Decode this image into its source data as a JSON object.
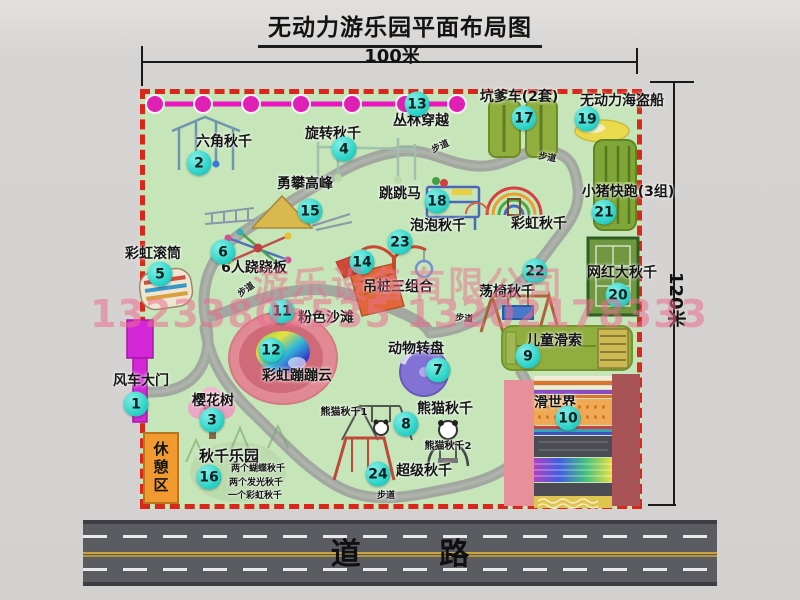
{
  "title": "无动力游乐园平面布局图",
  "dimensions": {
    "width": "100米",
    "height": "120米"
  },
  "road": {
    "label": "道 路"
  },
  "watermark": {
    "company": "游乐设备有限公司",
    "phone": "13233805535 13202178333"
  },
  "rest_area": {
    "label": "休憩区"
  },
  "colors": {
    "map_green": "#c6e6ba",
    "border_red": "#d8281c",
    "chain_magenta": "#e818bc",
    "badge_teal": "#2fd3c8",
    "road_gray": "#5b5b62",
    "rest_orange": "#f09a30"
  },
  "items": [
    {
      "num": "1",
      "label": "风车大门",
      "lx": 141,
      "ly": 374,
      "bx": 136,
      "by": 404
    },
    {
      "num": "2",
      "label": "六角秋千",
      "lx": 224,
      "ly": 135,
      "bx": 199,
      "by": 163
    },
    {
      "num": "3",
      "label": "樱花树",
      "lx": 213,
      "ly": 394,
      "bx": 212,
      "by": 420
    },
    {
      "num": "4",
      "label": "旋转秋千",
      "lx": 333,
      "ly": 127,
      "bx": 344,
      "by": 149
    },
    {
      "num": "5",
      "label": "彩虹滚筒",
      "lx": 153,
      "ly": 247,
      "bx": 160,
      "by": 274
    },
    {
      "num": "6",
      "label": "6人跷跷板",
      "lx": 254,
      "ly": 261,
      "bx": 223,
      "by": 252
    },
    {
      "num": "7",
      "label": "动物转盘",
      "lx": 416,
      "ly": 342,
      "bx": 438,
      "by": 370
    },
    {
      "num": "8",
      "label": "熊猫秋千",
      "lx": 445,
      "ly": 402,
      "bx": 406,
      "by": 424
    },
    {
      "num": "9",
      "label": "儿童滑索",
      "lx": 554,
      "ly": 334,
      "bx": 528,
      "by": 356
    },
    {
      "num": "10",
      "label": "滑世界",
      "lx": 555,
      "ly": 396,
      "bx": 568,
      "by": 418
    },
    {
      "num": "11",
      "label": "粉色沙滩",
      "lx": 326,
      "ly": 311,
      "bx": 282,
      "by": 311
    },
    {
      "num": "12",
      "label": "彩虹蹦蹦云",
      "lx": 297,
      "ly": 369,
      "bx": 271,
      "by": 350
    },
    {
      "num": "13",
      "label": "丛林穿越",
      "lx": 421,
      "ly": 114,
      "bx": 417,
      "by": 104
    },
    {
      "num": "14",
      "label": "吊桩三组合",
      "lx": 398,
      "ly": 280,
      "bx": 362,
      "by": 262
    },
    {
      "num": "15",
      "label": "勇攀高峰",
      "lx": 305,
      "ly": 177,
      "bx": 310,
      "by": 211
    },
    {
      "num": "16",
      "label": "秋千乐园",
      "lx": 229,
      "ly": 448,
      "bx": 209,
      "by": 477,
      "size": 15
    },
    {
      "num": "17",
      "label": "坑爹车(2套)",
      "lx": 519,
      "ly": 90,
      "bx": 524,
      "by": 118
    },
    {
      "num": "18",
      "label": "跳跳马",
      "lx": 400,
      "ly": 187,
      "bx": 437,
      "by": 201
    },
    {
      "num": "19",
      "label": "无动力海盗船",
      "lx": 622,
      "ly": 94,
      "bx": 587,
      "by": 119
    },
    {
      "num": "20",
      "label": "网红大秋千",
      "lx": 622,
      "ly": 266,
      "bx": 618,
      "by": 295
    },
    {
      "num": "21",
      "label": "小猪快跑(3组)",
      "lx": 628,
      "ly": 185,
      "bx": 604,
      "by": 212
    },
    {
      "num": "22",
      "label": "荡椅秋千",
      "lx": 507,
      "ly": 285,
      "bx": 535,
      "by": 271
    },
    {
      "num": "23",
      "label": "泡泡秋千",
      "lx": 438,
      "ly": 219,
      "bx": 400,
      "by": 242
    },
    {
      "num": "24",
      "label": "超级秋千",
      "lx": 424,
      "ly": 464,
      "bx": 378,
      "by": 474
    }
  ],
  "sub_labels": [
    {
      "text": "彩虹秋千",
      "x": 539,
      "y": 217,
      "size": 14
    },
    {
      "text": "熊猫秋千1",
      "x": 344,
      "y": 407,
      "size": 10
    },
    {
      "text": "熊猫秋千2",
      "x": 448,
      "y": 441,
      "size": 10
    },
    {
      "text": "两个蝴蝶秋千",
      "x": 258,
      "y": 465,
      "size": 9
    },
    {
      "text": "两个发光秋千",
      "x": 256,
      "y": 479,
      "size": 9
    },
    {
      "text": "一个彩虹秋千",
      "x": 255,
      "y": 492,
      "size": 9
    }
  ],
  "path_markers": [
    {
      "text": "步道",
      "x": 247,
      "y": 286,
      "rot": -35
    },
    {
      "text": "步道",
      "x": 441,
      "y": 143,
      "rot": -25
    },
    {
      "text": "步道",
      "x": 547,
      "y": 154,
      "rot": 10
    },
    {
      "text": "步道",
      "x": 464,
      "y": 315,
      "rot": 6
    },
    {
      "text": "步道",
      "x": 386,
      "y": 492,
      "rot": 0
    }
  ]
}
